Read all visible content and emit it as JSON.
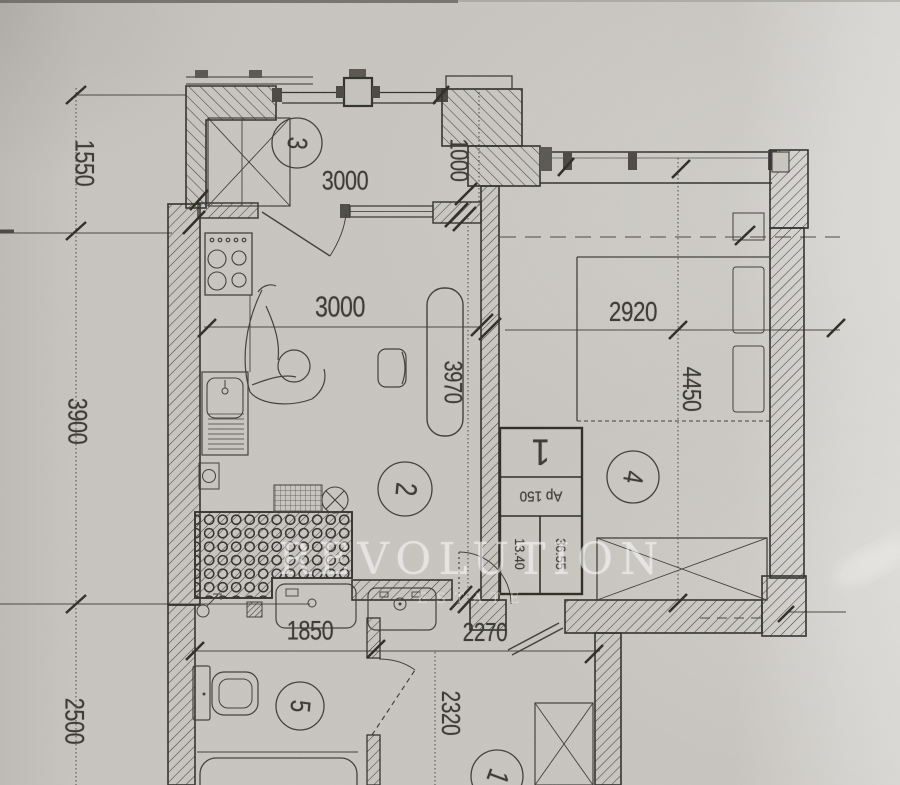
{
  "document": {
    "type": "apartment floor plan scan"
  },
  "watermark": {
    "title": "REVOLUTION",
    "subtitle": "ESTATE"
  },
  "dims": {
    "left_top": "1550",
    "left_middle": "3900",
    "left_bottom": "2500",
    "balcony_width": "3000",
    "balcony_depth": "1000",
    "kitchen_width": "3000",
    "kitchen_depth": "3970",
    "bedroom_width": "2920",
    "bedroom_depth": "4450",
    "bathroom_width": "1850",
    "hallway_width": "2270",
    "hallway_depth": "2320"
  },
  "rooms": {
    "balcony": "3",
    "kitchen": "2",
    "bedroom": "4",
    "bathroom": "5",
    "neighbor": "1"
  },
  "stamp": {
    "flat_number": "1",
    "flat_label": "Ap 150",
    "total_area": "36.55",
    "living_area": "13.40"
  },
  "colors": {
    "paper": "#c9c6c1",
    "ink": "#2b2a28",
    "watermark": "#ffffff"
  }
}
